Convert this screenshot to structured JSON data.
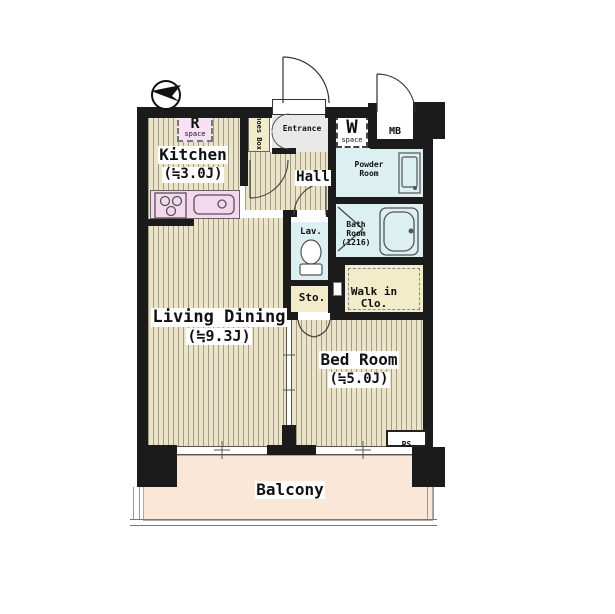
{
  "plan": {
    "title": "apartment-floor-plan",
    "rooms": {
      "kitchen": {
        "name": "Kitchen",
        "size": "(≒3.0J)"
      },
      "living_dining": {
        "name": "Living Dining",
        "size": "(≒9.3J)"
      },
      "bed_room": {
        "name": "Bed Room",
        "size": "(≒5.0J)"
      },
      "balcony": {
        "name": "Balcony"
      },
      "hall": {
        "name": "Hall"
      },
      "entrance": {
        "name": "Entrance"
      },
      "powder_room": {
        "name": "Powder Room"
      },
      "bath_room": {
        "name": "Bath Room",
        "size": "(1216)"
      },
      "lavatory": {
        "name": "Lav."
      },
      "storage": {
        "name": "Sto."
      },
      "walk_in_closet": {
        "name": "Walk in Clo."
      },
      "shoes_box": {
        "name": "Shoes Box"
      }
    },
    "labels": {
      "r_space_letter": "R",
      "r_space_word": "space",
      "w_space_letter": "W",
      "w_space_word": "space",
      "meter_box": "MB",
      "pipe_shaft": "PS"
    },
    "icons": {
      "compass": "north-arrow",
      "stove": "three-burner-stove",
      "sink": "kitchen-sink",
      "washbasin": "washbasin",
      "bathtub": "bathtub",
      "toilet": "toilet"
    },
    "colors": {
      "wall": "#1b1b1b",
      "flooring": "#ebe4c8",
      "flooring_stripe": "#a39d85",
      "wet_area": "#dceff1",
      "counter_pink": "#f6d8ee",
      "closet_cream": "#f3ecca",
      "entrance_gray": "#e9e9e9",
      "balcony_peach": "#fbe7d8",
      "label_bg": "#ffffff"
    }
  }
}
